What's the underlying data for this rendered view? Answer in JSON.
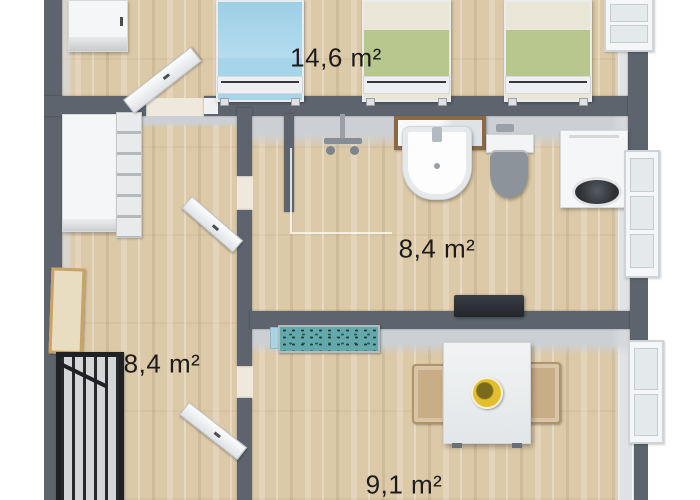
{
  "rooms": [
    {
      "name": "top-bedroom",
      "area_label": "14,6 m²"
    },
    {
      "name": "bathroom",
      "area_label": "8,4 m²"
    },
    {
      "name": "left-bedroom",
      "area_label": "8,4 m²"
    },
    {
      "name": "dining-room",
      "area_label": "9,1 m²"
    }
  ],
  "furniture": [
    "wardrobe-top-left",
    "single-bed-blue",
    "single-bed-green-1",
    "single-bed-green-2",
    "closet-shelf",
    "wardrobe-left",
    "picture-frame",
    "baby-crib",
    "shower-faucet",
    "shower-glass",
    "bathroom-mirror",
    "washbasin",
    "toilet",
    "flush-plate",
    "washing-machine",
    "wall-tv",
    "aquarium",
    "dining-table",
    "chair-left",
    "chair-right",
    "fruit-bowl",
    "door-top-bedroom",
    "door-bathroom",
    "door-dining-room",
    "window-top-right",
    "window-bathroom",
    "window-dining"
  ],
  "colors": {
    "wall": "#5d646d",
    "wall_face": "#ccd0d5",
    "floor": "#dcc9a7",
    "bed_blue": "#a6d4e8",
    "bed_green": "#b8c78e",
    "bed_linen": "#eae6d8",
    "aquarium_teal": "#63a9ac",
    "bowl_yellow": "#e3bf2e",
    "chair_tan": "#c9ad86",
    "mirror_frame_brown": "#8a6a45",
    "crib_black": "#202124",
    "label_text": "#1c1c1c",
    "outside": "#ffffff"
  }
}
